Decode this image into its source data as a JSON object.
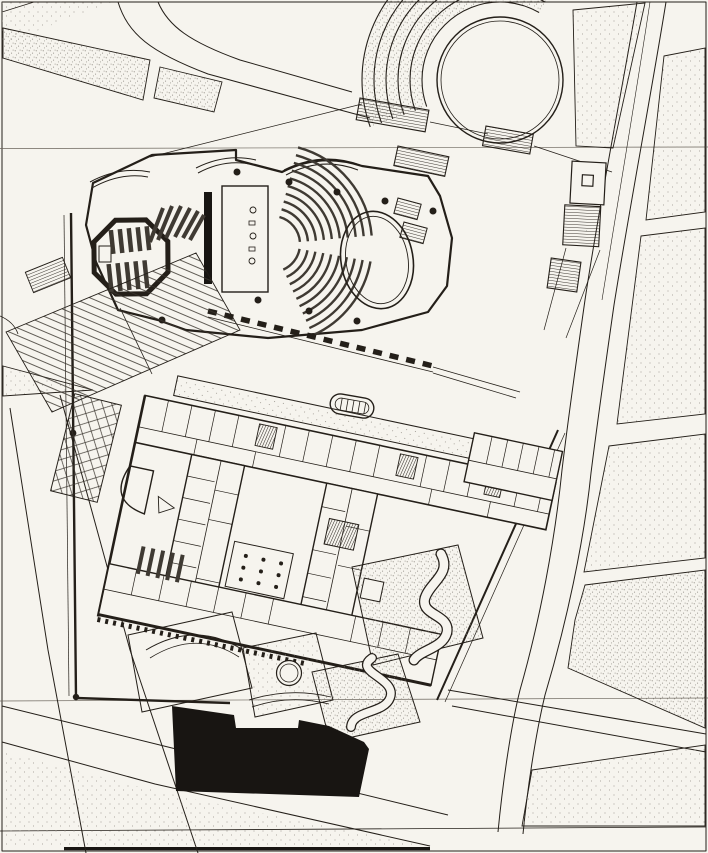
{
  "document": {
    "kind": "architectural site plan drawing",
    "media": "black ink line drawing on off-white paper (scan)",
    "subject": "Concert-hall and music-school complex set in an urban street grid, with a terraced circular plaza, entrance stair plaza, garden courtyards with serpentine paths, and an existing neighbouring building rendered as a solid black mass",
    "visible_text": "none",
    "orientation_note": "building complex is rotated against the diagonal street grid"
  },
  "colors": {
    "paper": "#f6f4ee",
    "ink": "#241f19",
    "ink_soft": "#4a443c",
    "seat_rows": "#3f3a33",
    "solid_building": "#181512",
    "stipple": "#7d7870",
    "hairline": "#6b655c"
  },
  "elements": [
    {
      "id": "circular-plaza",
      "label": "Circular plaza",
      "description": "large double-line circle, top right"
    },
    {
      "id": "plaza-terrace-arcs",
      "label": "Terraced arcs",
      "description": "concentric stepped terraces wrapping the circle's west side"
    },
    {
      "id": "main-auditorium",
      "label": "Main auditorium",
      "description": "fan-shaped seating in two banks facing the stage"
    },
    {
      "id": "orchestra-ellipse",
      "label": "Elliptical hall end",
      "description": "double-line oval enclosing the east end of the auditorium"
    },
    {
      "id": "stage",
      "label": "Stage",
      "description": "rectangular stage with heavy proscenium wall band"
    },
    {
      "id": "octagonal-hall",
      "label": "Octagonal recital hall",
      "description": "thick-walled octagon with two banks of straight seat rows"
    },
    {
      "id": "rehearsal-seating",
      "label": "Rehearsal room rows",
      "description": "slanted seat bars north-east of the octagon"
    },
    {
      "id": "entrance-plaza-steps",
      "label": "Entrance stair plaza",
      "description": "wide terraced steps on the west side"
    },
    {
      "id": "foyer-glazing",
      "label": "Foyer glazing",
      "description": "dashed heavy line of the south foyer facade"
    },
    {
      "id": "school-wings",
      "label": "School/office wings",
      "description": "rotated orthogonal wings with small rooms and corridors"
    },
    {
      "id": "courtyard-dots",
      "label": "Columned courtyard",
      "description": "court with grid of column dots"
    },
    {
      "id": "stair-hatches",
      "label": "Stairs",
      "description": "densely hatched stair blocks"
    },
    {
      "id": "footbridge",
      "label": "Footbridge / ramps",
      "description": "hatched switch-back ramps crossing toward the boulevard"
    },
    {
      "id": "garden-parcels",
      "label": "Garden courtyards",
      "description": "stippled parcels with serpentine paths, pavilion square, round fountain and arc terraces"
    },
    {
      "id": "existing-building",
      "label": "Existing building",
      "description": "solid black mass at the bottom of the site"
    },
    {
      "id": "boulevard",
      "label": "Boulevard",
      "description": "diagonal avenue running down the right side"
    },
    {
      "id": "city-blocks",
      "label": "City blocks",
      "description": "stippled street blocks of the surrounding town"
    },
    {
      "id": "registration-hairlines",
      "label": "Sheet hairlines",
      "description": "two faint horizontal lines across the sheet"
    }
  ]
}
